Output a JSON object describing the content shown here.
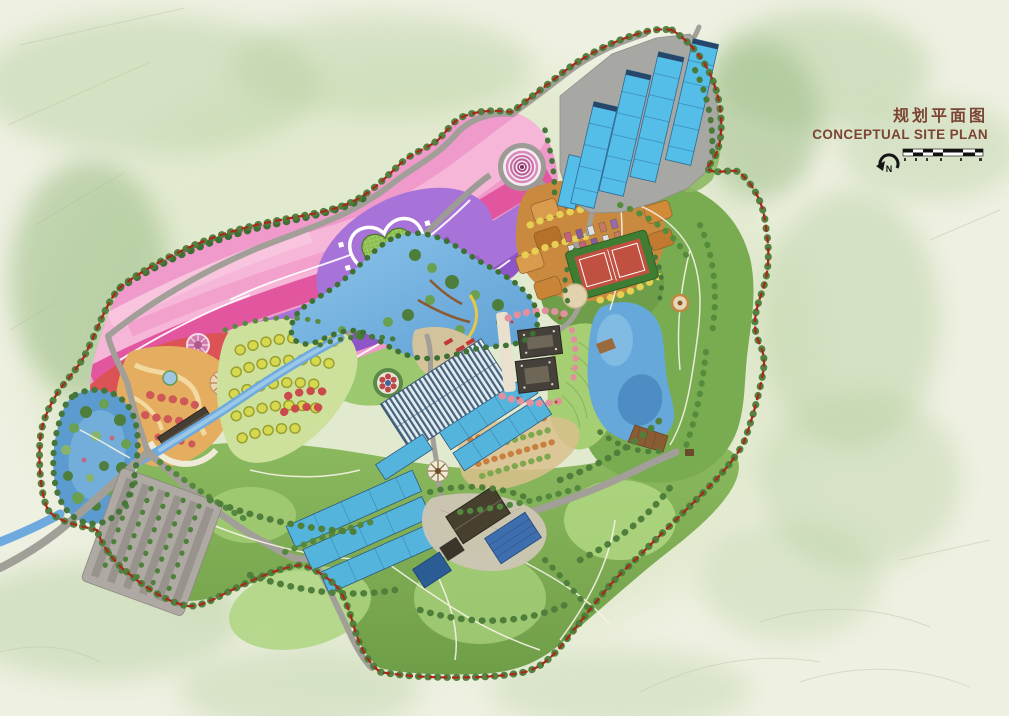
{
  "document": {
    "kind": "landscape master plan rendering",
    "background_color": "#eef0e1"
  },
  "title_block": {
    "title_zh": "规划平面图",
    "title_en": "CONCEPTUAL SITE PLAN",
    "text_color": "#7b4434",
    "compass_label": "N",
    "scale_bar_segments": 5
  },
  "palette": {
    "boundary_red": "#a8281a",
    "road_gray": "#a29f98",
    "trail_white": "#f7f3e6",
    "water_blue": "#66a8da",
    "water_light": "#8cc4ea",
    "greenhouse_blue": "#54bee8",
    "forest_dark": "#4c7c3a",
    "forest_mid": "#79ab50",
    "lawn_light": "#aed581",
    "flower_pink": "#ef9aca",
    "flower_magenta": "#e2569f",
    "flower_purple": "#a873d8",
    "flower_violet": "#8d55c6",
    "flower_red": "#dc5356",
    "flower_coral": "#f08a80",
    "orchard_orange": "#c98a40",
    "orchard_dot_yellow": "#d6d94e",
    "entrance_orange": "#e5ad5f",
    "court_red": "#c0503f",
    "building_dark": "#45403a",
    "deck_brown": "#8a5c34",
    "parking_gray": "#aeaaa3",
    "wash_green": "#b6cfa0"
  },
  "map_features": [
    "flower-field-terraces",
    "heart-garden",
    "spiral-plaza",
    "entrance-garden",
    "orchard-grid",
    "greenhouse-cluster-north",
    "greenhouse-cluster-central",
    "greenhouse-cluster-south",
    "farm-compound",
    "parking-lot",
    "wetland-pond",
    "central-lake",
    "east-lake",
    "river-corridor",
    "resort-courtyard-buildings",
    "sports-courts",
    "cabin-rows",
    "south-forest-hills",
    "east-forest-hills",
    "site-boundary",
    "ring-road",
    "walking-trails"
  ]
}
